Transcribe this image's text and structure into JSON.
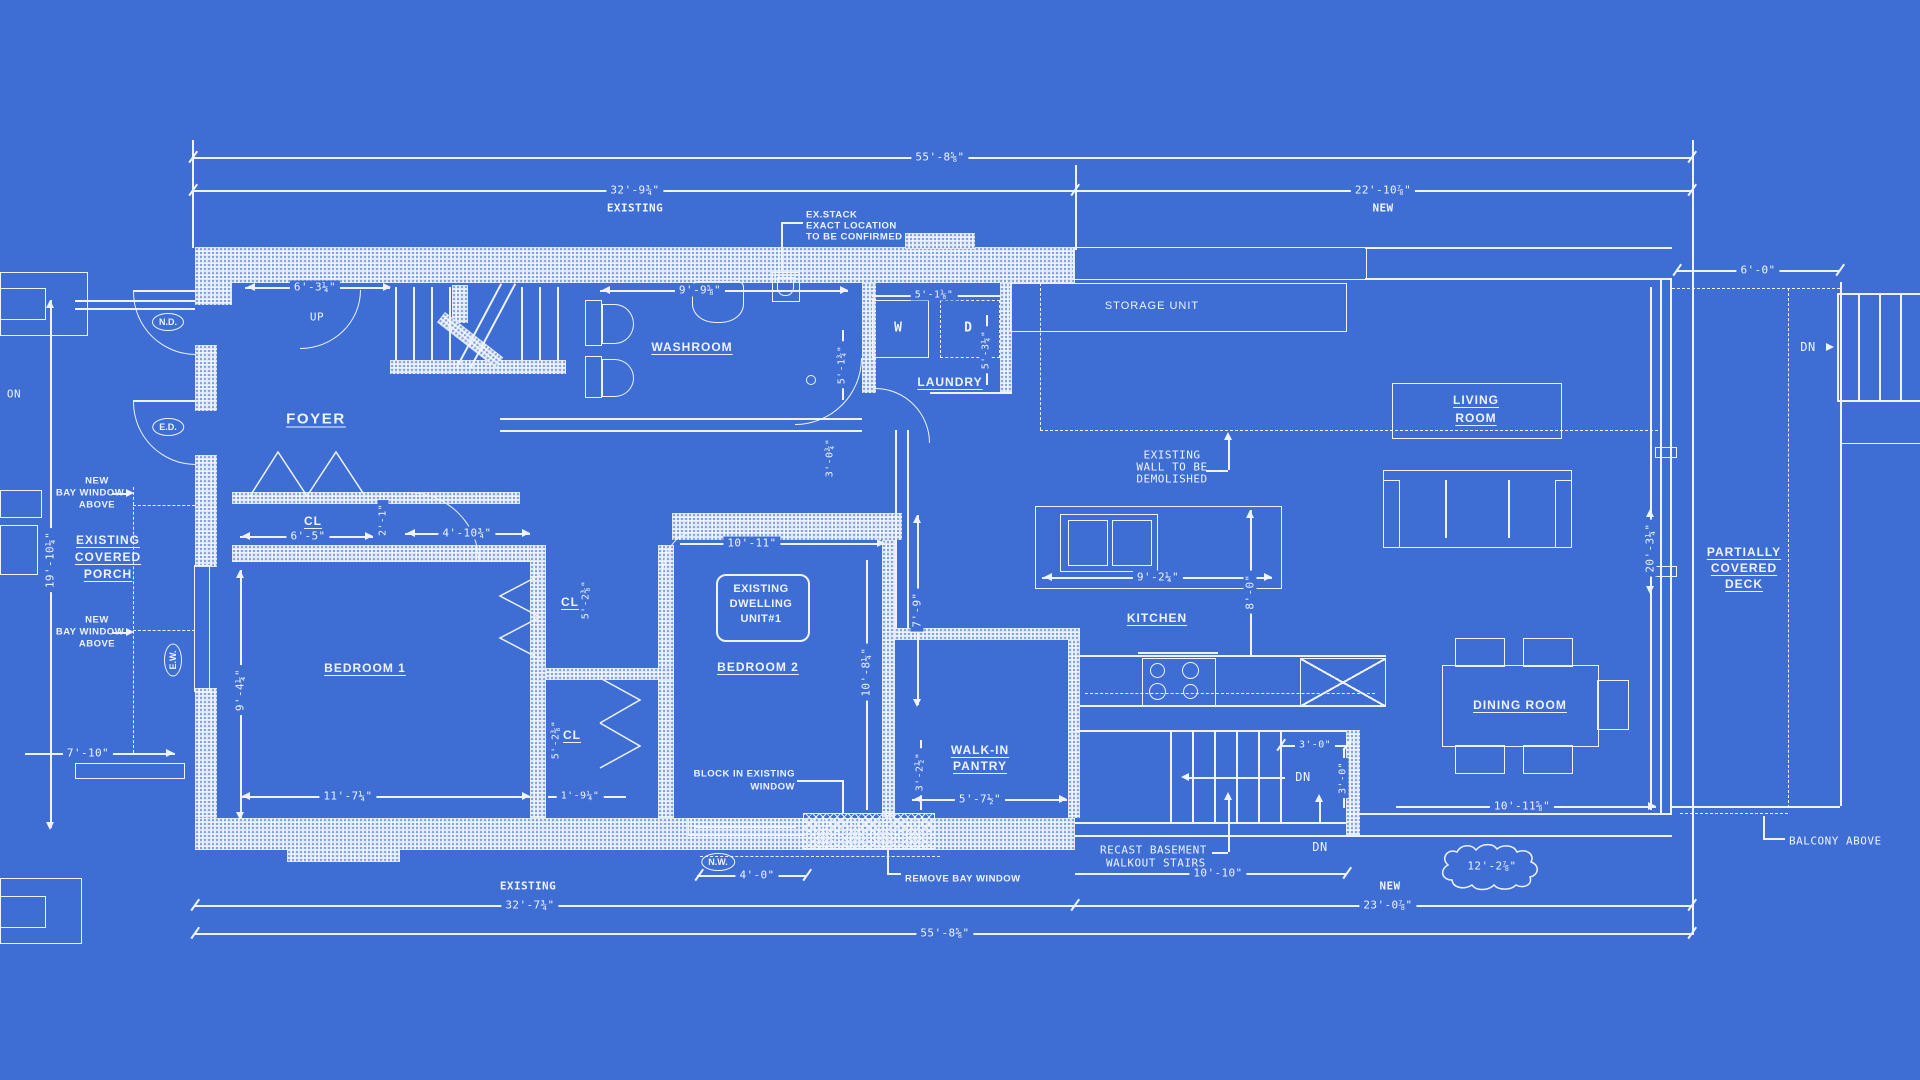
{
  "rooms": {
    "foyer": "FOYER",
    "washroom": "WASHROOM",
    "laundry": "LAUNDRY",
    "kitchen": "KITCHEN",
    "dining": "DINING ROOM",
    "bed1": "BEDROOM 1",
    "bed2": "BEDROOM 2",
    "storage": "STORAGE UNIT",
    "living1": "LIVING",
    "living2": "ROOM",
    "pantry1": "WALK-IN",
    "pantry2": "PANTRY",
    "porch1": "EXISTING",
    "porch2": "COVERED",
    "porch3": "PORCH",
    "deck1": "PARTIALLY",
    "deck2": "COVERED",
    "deck3": "DECK",
    "cl": "CL",
    "unit1": "EXISTING",
    "unit2": "DWELLING",
    "unit3": "UNIT#1"
  },
  "markers": {
    "nd": "N.D.",
    "ed": "E.D.",
    "ew": "E.W.",
    "nw": "N.W.",
    "up": "UP",
    "dn": "DN",
    "w": "W",
    "d": "D",
    "on": "ON"
  },
  "notes": {
    "exstack1": "EX.STACK",
    "exstack2": "EXACT LOCATION",
    "exstack3": "TO BE CONFIRMED",
    "demo1": "EXISTING",
    "demo2": "WALL TO BE",
    "demo3": "DEMOLISHED",
    "recast1": "RECAST BASEMENT",
    "recast2": "WALKOUT STAIRS",
    "block1": "BLOCK IN EXISTING",
    "block2": "WINDOW",
    "removebay": "REMOVE BAY WINDOW",
    "balcony": "BALCONY ABOVE",
    "bay1": "NEW",
    "bay2": "BAY WINDOW",
    "bay3": "ABOVE"
  },
  "dims": {
    "top_total": "55'-8⅝\"",
    "top_exist": "32'-9¾\"",
    "top_exist_sub": "EXISTING",
    "top_new": "22'-10⅞\"",
    "top_new_sub": "NEW",
    "foyer_w": "6'-3¼\"",
    "wash_w": "9'-9⅝\"",
    "wd_w": "5'-1⅛\"",
    "wash_h": "5'-1¾\"",
    "laundry_h": "5'-3¼\"",
    "hall_v": "3'-0¾\"",
    "cl_w": "6'-5\"",
    "cl_small": "2'-1\"",
    "hall_foyer": "4'-10¾\"",
    "cl1_h": "5'-2⅜\"",
    "cl2_h": "5'-2⅜\"",
    "cl_bottom": "1'-9¼\"",
    "bed1_h": "9'-4¼\"",
    "bed1_w": "11'-7¼\"",
    "porch_h": "19'-10¼\"",
    "porch_w": "7'-10\"",
    "bed2_w": "10'-11\"",
    "bed2_h": "10'-8¼\"",
    "corridor_h": "7'-9\"",
    "pantry_v": "3'-2½\"",
    "pantry_w": "5'-7½\"",
    "bay_w": "4'-0\"",
    "bot_exist": "32'-7¾\"",
    "bot_exist_sub": "EXISTING",
    "bot_total": "55'-8⅝\"",
    "bot_new": "23'-0⅞\"",
    "bot_new_sub": "NEW",
    "stairs_w": "10'-10\"",
    "landing_w": "3'-0\"",
    "landing_h": "3'-0\"",
    "dining_w": "10'-11⅝\"",
    "cloud": "12'-2⅞\"",
    "island_w": "9'-2¼\"",
    "kitchen_h": "8'-0\"",
    "wing_h": "20'-3¼\"",
    "deck_w": "6'-0\""
  }
}
